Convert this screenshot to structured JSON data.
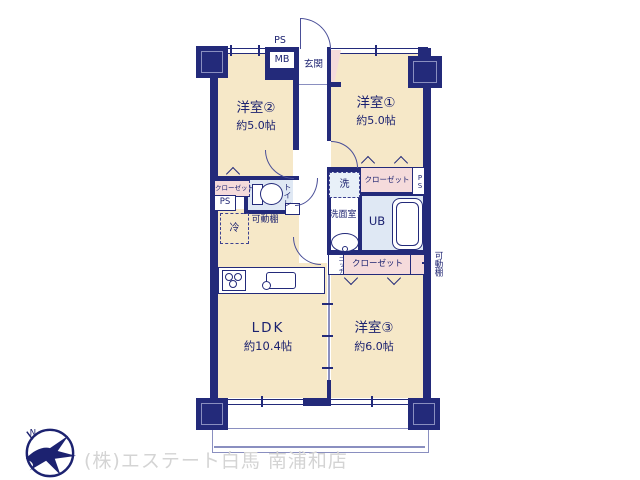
{
  "colors": {
    "wall": "#232a7a",
    "floor": "#f6e8c8",
    "closet_pink": "#f5dbdb",
    "wet_area_blue": "#dfe8f4",
    "watermark_gray": "#d4d4d4"
  },
  "floorplan": {
    "entrance_label": "玄関",
    "ps_top": "PS",
    "mb": "MB",
    "rooms": {
      "room2": {
        "name": "洋室②",
        "size": "約5.0帖"
      },
      "room1": {
        "name": "洋室①",
        "size": "約5.0帖"
      },
      "room3": {
        "name": "洋室③",
        "size": "約6.0帖"
      },
      "ldk": {
        "name": "LDK",
        "size": "約10.4帖"
      },
      "toilet": "トイレ",
      "washroom": "洗面室",
      "bath": "UB"
    },
    "features": {
      "closet_left": "クローゼット",
      "ps_left": "PS",
      "fridge": "冷",
      "shelf_ldk": "可動棚",
      "washer": "洗",
      "closet_room1": "クローゼット",
      "ps_right": "PS",
      "niche": "ニッチ",
      "closet_room3": "クローゼット",
      "shelf_right": "可動棚"
    }
  },
  "footer": {
    "company": "(株)エステート白馬 南浦和店",
    "compass_n": "N"
  }
}
